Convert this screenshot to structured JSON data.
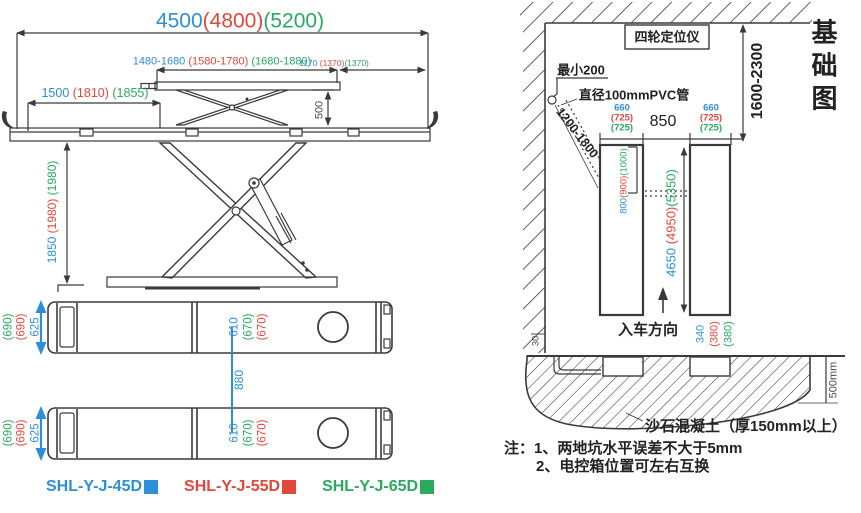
{
  "colors": {
    "model_45d_blue": "#2e8fd8",
    "model_55d_red": "#e2473c",
    "model_65d_green": "#2aa95f",
    "line": "#3a3a3a"
  },
  "side_view": {
    "dim_overall_length": [
      "4500",
      "(4800)",
      "(5200)"
    ],
    "dim_upper_platform_range": [
      "1480-1680",
      " (1580-1780)",
      " (1680-1880)"
    ],
    "dim_rear_offset": [
      "1170",
      " (1370)",
      "(1370)"
    ],
    "dim_ramp_length": [
      "1500",
      " (1810)",
      " (1855)"
    ],
    "dim_sub_platform_height": "500",
    "dim_raise_height": [
      "1850",
      " (1980)",
      " (1980)"
    ]
  },
  "top_view": {
    "dim_platform_width": {
      "g": "(690)",
      "r": "(690)",
      "b": "625"
    },
    "dim_inner_width": {
      "b": "610",
      "g": "(670)",
      "r": "(670)"
    },
    "dim_track_center_gap": "880"
  },
  "legend": {
    "items": [
      {
        "label": "SHL-Y-J-45D"
      },
      {
        "label": "SHL-Y-J-55D"
      },
      {
        "label": "SHL-Y-J-65D"
      }
    ]
  },
  "foundation": {
    "title": "基础图",
    "aligner_box_label": "四轮定位仪",
    "dim_wall_distance_range": "1600-2300",
    "min_clearance_label": "最小200",
    "pvc_pipe_label": "直径100mmPVC管",
    "dim_pipe_run_range": "1200-1800",
    "dim_pit_width": {
      "b": "660",
      "r": "(725)",
      "g": "(725)"
    },
    "dim_pit_spacing": "850",
    "dim_pit_head_length": [
      "800",
      "(900)",
      "(1000)"
    ],
    "dim_pit_length": [
      "4650",
      " (4950)",
      "(5350)"
    ],
    "drive_in_direction_label": "入车方向",
    "dim_pit_tail": {
      "b": "340",
      "r": "(380)",
      "g": "(380)"
    },
    "dim_wall_edge": "30",
    "dim_section_depth": "500mm",
    "concrete_label": "沙石混凝土（厚150mm以上）",
    "note_line1": "注：1、两地坑水平误差不大于5mm",
    "note_line2": "2、电控箱位置可左右互换"
  }
}
